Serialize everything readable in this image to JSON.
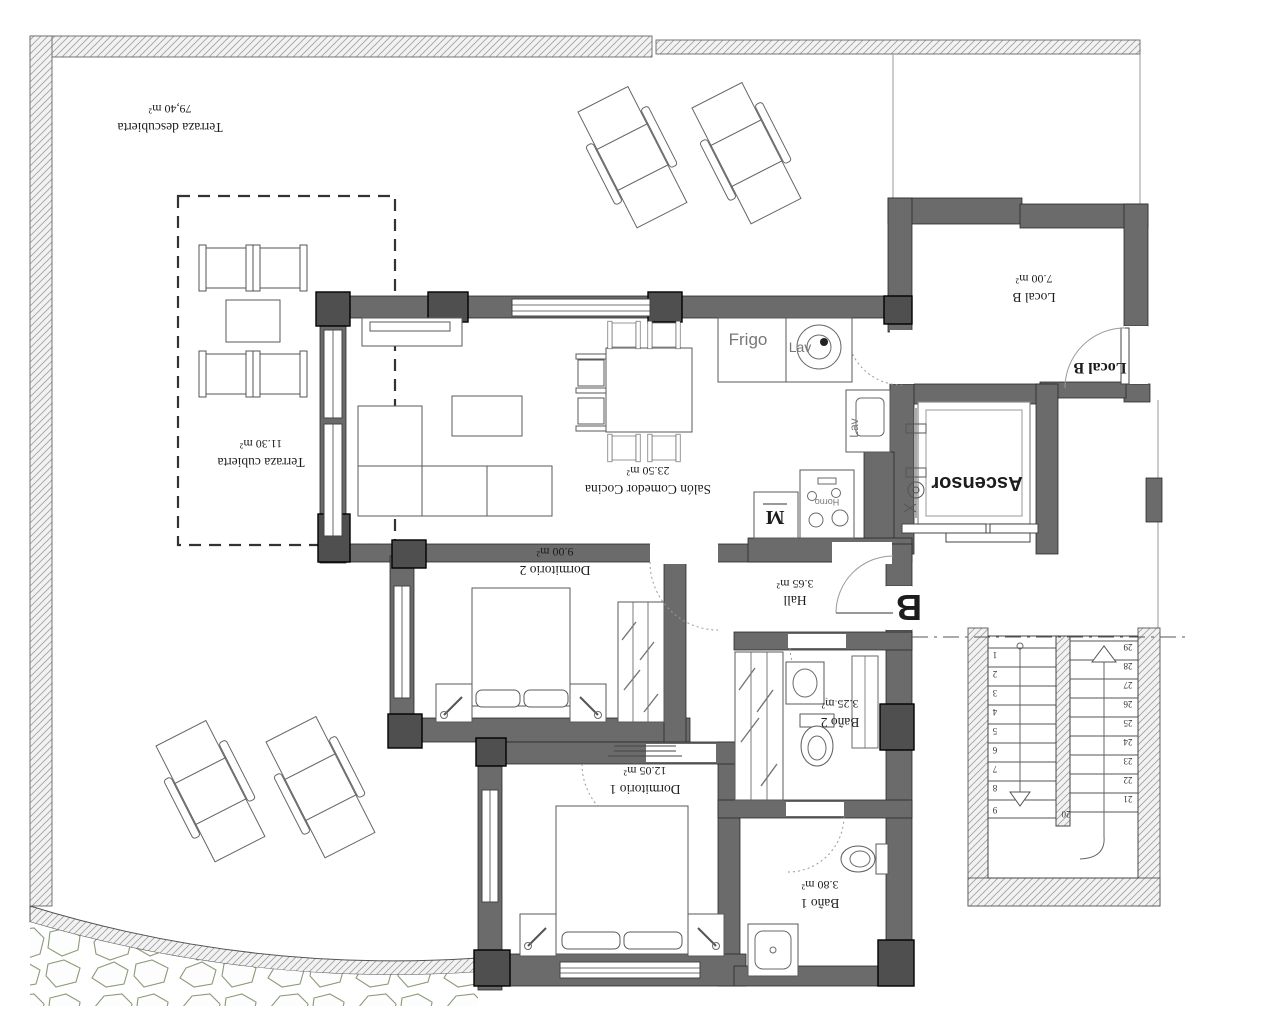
{
  "plan": {
    "title": "Apartment B floor plan",
    "rooms": [
      {
        "name": "Terraza descubierta",
        "area": "79,40 m²"
      },
      {
        "name": "Terraza cubierta",
        "area": "11.30 m²"
      },
      {
        "name": "Local B",
        "area": "7.00 m²"
      },
      {
        "name": "Salón Comedor Cocina",
        "area": "23.50 m²"
      },
      {
        "name": "Dormitorio 2",
        "area": "9.00 m²"
      },
      {
        "name": "Hall",
        "area": "3.65 m²"
      },
      {
        "name": "Baño 2",
        "area": "3.25 m²"
      },
      {
        "name": "Dormitorio 1",
        "area": "12.05 m²"
      },
      {
        "name": "Baño 1",
        "area": "3.80 m²"
      }
    ],
    "labels": {
      "ascensor": "Ascensor",
      "unit_letter": "B",
      "local_b_door": "Local B",
      "frigo": "Frigo",
      "lav_washer": "Lav",
      "lav_sink": "Lav",
      "microwave": "M",
      "horno": "Horno"
    },
    "stairs": {
      "left_numbers": [
        "1",
        "2",
        "3",
        "4",
        "5",
        "6",
        "7",
        "8",
        "9"
      ],
      "right_numbers": [
        "29",
        "28",
        "27",
        "26",
        "25",
        "24",
        "23",
        "22",
        "21"
      ],
      "bottom_number": "20"
    },
    "colors": {
      "wall": "#6b6b6b",
      "pillar": "#4f4f4f",
      "stone_outline": "#8a9a78",
      "hatch_line": "#a0a0a0",
      "door_arc": "#999999"
    }
  }
}
